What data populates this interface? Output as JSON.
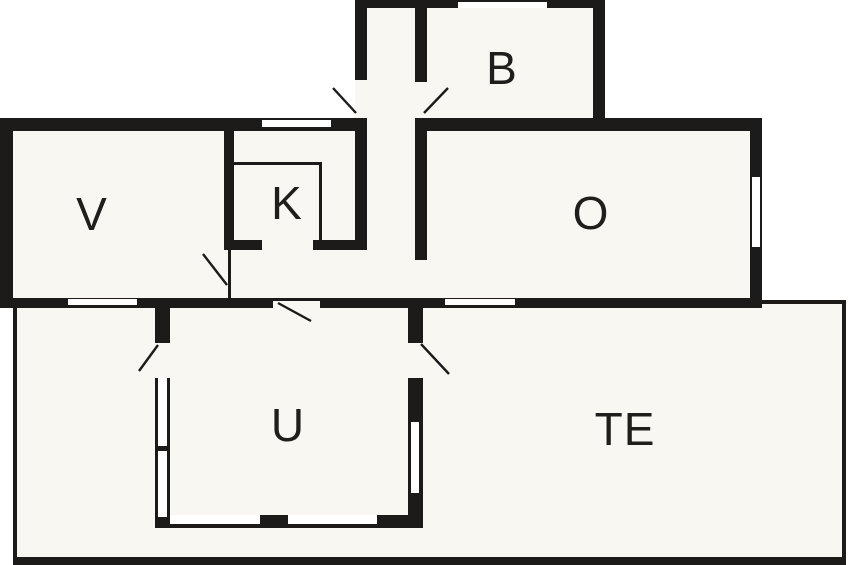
{
  "canvas": {
    "width": 848,
    "height": 565
  },
  "colors": {
    "background": "#ffffff",
    "floor": "#f8f7f1",
    "wall": "#1d1b1a",
    "label": "#1f1e1d"
  },
  "rooms": [
    {
      "id": "v",
      "label": "V",
      "cx": 92,
      "cy": 214
    },
    {
      "id": "k",
      "label": "K",
      "cx": 287,
      "cy": 203
    },
    {
      "id": "b",
      "label": "B",
      "cx": 502,
      "cy": 68
    },
    {
      "id": "o",
      "label": "O",
      "cx": 591,
      "cy": 213
    },
    {
      "id": "u",
      "label": "U",
      "cx": 288,
      "cy": 425
    },
    {
      "id": "te",
      "label": "TE",
      "cx": 625,
      "cy": 429
    }
  ],
  "geometry": {
    "floors": [
      [
        355,
        0,
        250,
        131,
        "floor-entry-annex"
      ],
      [
        0,
        118,
        762,
        190,
        "floor-main-band"
      ],
      [
        13,
        300,
        833,
        265,
        "floor-terrace"
      ]
    ],
    "walls": [
      [
        355,
        0,
        250,
        8,
        "wall-annex-top"
      ],
      [
        355,
        0,
        12,
        80,
        "wall-annex-left"
      ],
      [
        593,
        0,
        12,
        131,
        "wall-annex-right"
      ],
      [
        415,
        8,
        12,
        74,
        "wall-bath-divider"
      ],
      [
        0,
        118,
        367,
        13,
        "wall-top-west"
      ],
      [
        415,
        118,
        347,
        13,
        "wall-top-east"
      ],
      [
        0,
        118,
        13,
        190,
        "wall-west"
      ],
      [
        355,
        131,
        12,
        117,
        "wall-k-east"
      ],
      [
        415,
        131,
        12,
        129,
        "wall-o-west"
      ],
      [
        224,
        131,
        10,
        117,
        "wall-v-east"
      ],
      [
        224,
        240,
        38,
        10,
        "wall-k-south-west"
      ],
      [
        313,
        240,
        54,
        10,
        "wall-k-south-east"
      ],
      [
        0,
        298,
        273,
        10,
        "wall-south-west"
      ],
      [
        320,
        298,
        442,
        10,
        "wall-south-east"
      ],
      [
        750,
        118,
        12,
        190,
        "wall-o-east"
      ],
      [
        155,
        308,
        15,
        35,
        "wall-u-west-top"
      ],
      [
        155,
        378,
        15,
        139,
        "wall-u-west"
      ],
      [
        155,
        515,
        268,
        13,
        "wall-u-south"
      ],
      [
        408,
        308,
        15,
        35,
        "wall-u-east-top"
      ],
      [
        408,
        378,
        15,
        139,
        "wall-u-east"
      ]
    ],
    "windows": [
      [
        458,
        2,
        89,
        6,
        "window-annex-north"
      ],
      [
        262,
        120,
        69,
        7,
        "window-north"
      ],
      [
        68,
        299,
        69,
        6,
        "window-v-south"
      ],
      [
        445,
        299,
        70,
        6,
        "window-o-south"
      ],
      [
        752,
        177,
        8,
        70,
        "window-o-east"
      ],
      [
        158,
        378,
        9,
        68,
        "window-u-west-1"
      ],
      [
        158,
        451,
        9,
        66,
        "window-u-west-2"
      ],
      [
        170,
        515,
        90,
        9,
        "window-u-south-1"
      ],
      [
        288,
        515,
        89,
        9,
        "window-u-south-2"
      ],
      [
        411,
        422,
        8,
        71,
        "window-u-east"
      ]
    ],
    "thin": [
      [
        234,
        162,
        88,
        3,
        "counter-top-line"
      ],
      [
        319,
        162,
        3,
        78,
        "counter-side-line"
      ],
      [
        228,
        250,
        3,
        48,
        "door-leaf-v"
      ],
      [
        273,
        298,
        47,
        3,
        "lintel-u-top-door"
      ],
      [
        13,
        308,
        4,
        257,
        "terrace-edge-west"
      ],
      [
        13,
        557,
        833,
        8,
        "terrace-edge-south"
      ],
      [
        842,
        300,
        4,
        265,
        "terrace-edge-east"
      ],
      [
        762,
        300,
        84,
        4,
        "terrace-edge-north"
      ]
    ],
    "doors": [
      [
        333,
        88,
        356,
        113,
        "door-swing-entrance"
      ],
      [
        448,
        88,
        424,
        113,
        "door-swing-bath"
      ],
      [
        203,
        254,
        227,
        285,
        "door-swing-v"
      ],
      [
        278,
        303,
        311,
        321,
        "door-swing-u-top"
      ],
      [
        158,
        345,
        139,
        371,
        "door-swing-u-left"
      ],
      [
        421,
        344,
        449,
        374,
        "door-swing-u-right"
      ]
    ]
  }
}
